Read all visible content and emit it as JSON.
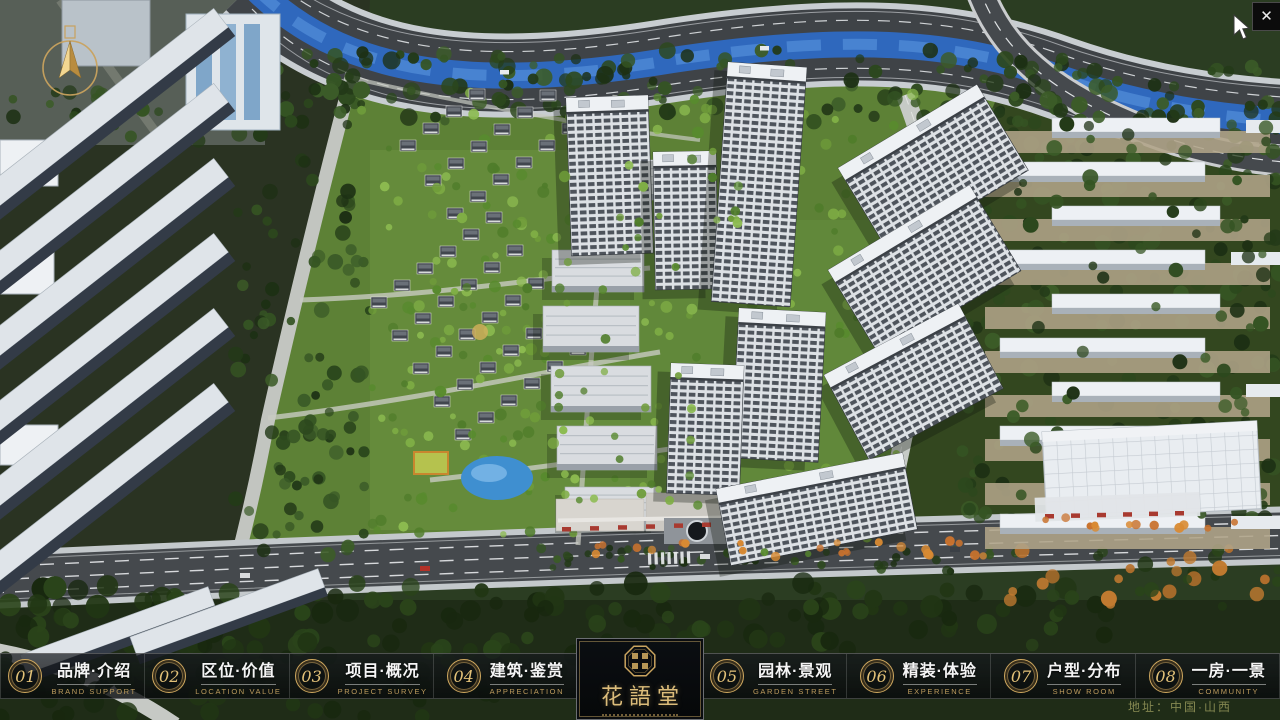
{
  "window": {
    "close_label": "✕"
  },
  "nav": {
    "items": [
      {
        "num": "01",
        "zh": "品牌·介绍",
        "en": "BRAND SUPPORT"
      },
      {
        "num": "02",
        "zh": "区位·价值",
        "en": "LOCATION VALUE"
      },
      {
        "num": "03",
        "zh": "项目·概况",
        "en": "PROJECT SURVEY"
      },
      {
        "num": "04",
        "zh": "建筑·鉴赏",
        "en": "APPRECIATION"
      },
      {
        "num": "05",
        "zh": "园林·景观",
        "en": "GARDEN STREET"
      },
      {
        "num": "06",
        "zh": "精装·体验",
        "en": "EXPERIENCE"
      },
      {
        "num": "07",
        "zh": "户型·分布",
        "en": "SHOW ROOM"
      },
      {
        "num": "08",
        "zh": "一房·一景",
        "en": "COMMUNITY"
      }
    ]
  },
  "logo": {
    "title": "花語堂"
  },
  "footer": {
    "address": "地址：中国·山西"
  },
  "icons": {
    "compass": "north-compass",
    "seal": "hua-yu-tang-seal",
    "close": "close-x"
  },
  "colors": {
    "gold": "#C9A25E",
    "river": "#2F68BD",
    "lawn": "#5D8136",
    "road": "#45494D"
  }
}
